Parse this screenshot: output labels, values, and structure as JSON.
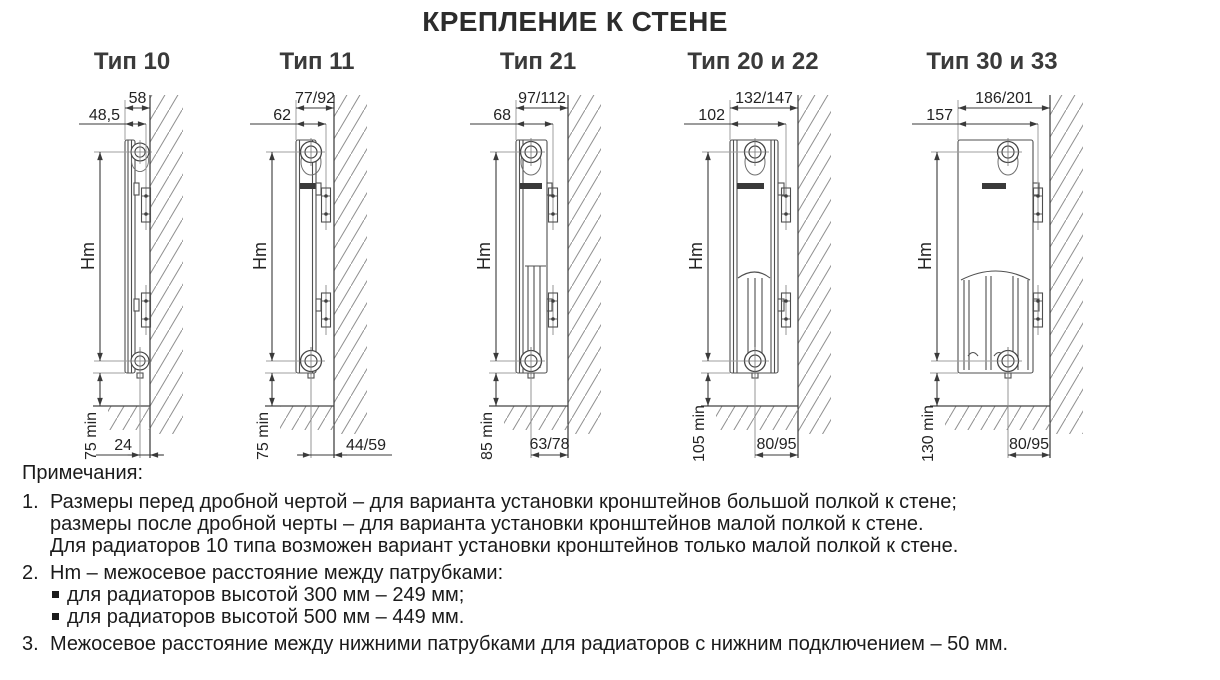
{
  "page_title": "КРЕПЛЕНИЕ К СТЕНЕ",
  "colors": {
    "accent_dim_text": "#3e4e66",
    "drawing_line": "#4f4f4f",
    "dim_line": "#3a3a3a",
    "text": "#1b1b1b"
  },
  "figures": [
    {
      "title": "Тип 10",
      "depth_total": "58",
      "bracket_offset": "48,5",
      "axis_label": "Hm",
      "floor_min": "75 min",
      "pipe_to_wall": "24"
    },
    {
      "title": "Тип 11",
      "depth_total": "77/92",
      "bracket_offset": "62",
      "axis_label": "Hm",
      "floor_min": "75 min",
      "pipe_to_wall": "44/59"
    },
    {
      "title": "Тип 21",
      "depth_total": "97/112",
      "bracket_offset": "68",
      "axis_label": "Hm",
      "floor_min": "85 min",
      "pipe_to_wall": "63/78"
    },
    {
      "title": "Тип 20 и 22",
      "depth_total": "132/147",
      "bracket_offset": "102",
      "axis_label": "Hm",
      "floor_min": "105 min",
      "pipe_to_wall": "80/95"
    },
    {
      "title": "Тип 30 и 33",
      "depth_total": "186/201",
      "bracket_offset": "157",
      "axis_label": "Hm",
      "floor_min": "130 min",
      "pipe_to_wall": "80/95"
    }
  ],
  "notes": {
    "heading": "Примечания:",
    "items": [
      {
        "num": "1.",
        "lines": [
          "Размеры перед дробной чертой – для варианта установки кронштейнов большой полкой к стене;",
          "размеры после дробной черты – для варианта установки кронштейнов малой полкой к стене.",
          "Для радиаторов 10 типа возможен вариант установки кронштейнов только малой полкой к стене."
        ]
      },
      {
        "num": "2.",
        "lines": [
          "Hm – межосевое расстояние между патрубками:"
        ],
        "bullets": [
          "для радиаторов высотой 300 мм – 249 мм;",
          "для радиаторов высотой 500 мм – 449 мм."
        ]
      },
      {
        "num": "3.",
        "lines": [
          "Межосевое расстояние между нижними патрубками для радиаторов с нижним подключением – 50 мм."
        ]
      }
    ]
  }
}
